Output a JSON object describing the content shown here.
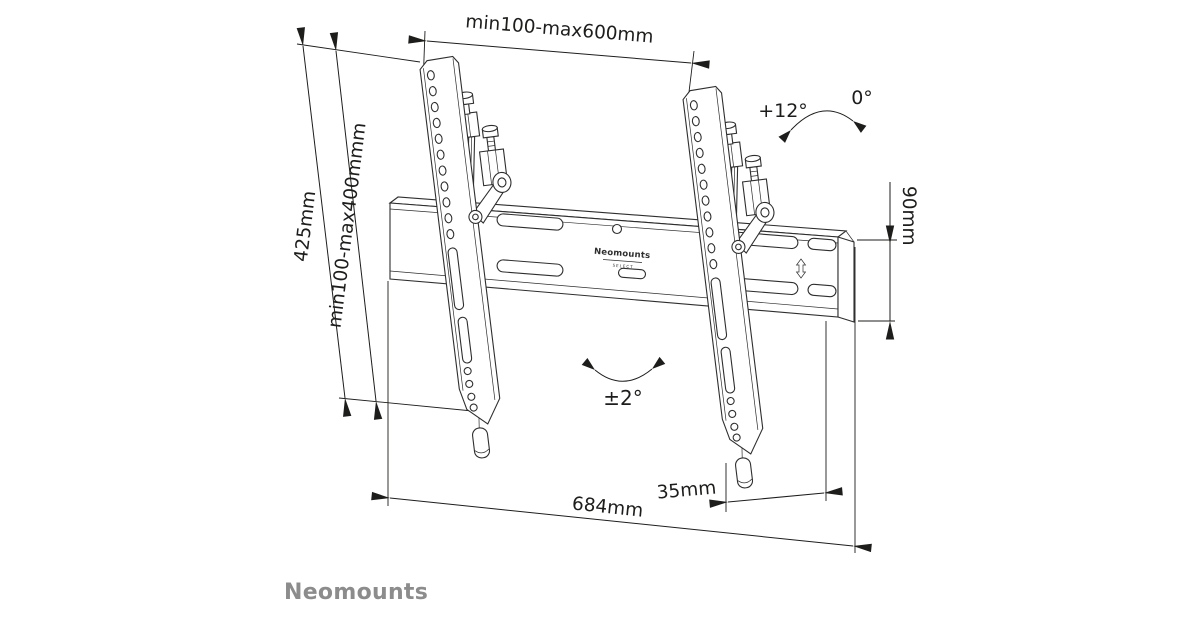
{
  "colors": {
    "background": "#ffffff",
    "line": "#1d1d1b",
    "part_line": "#2e2e2e",
    "brand_gray": "#8c8c8c"
  },
  "dimensions": {
    "top_width": "min100-max600mm",
    "overall_height": "425mm",
    "vesa_height": "min100-max400mmm",
    "tilt_max": "+12°",
    "tilt_min": "0°",
    "rail_height": "90mm",
    "swivel_range": "±2°",
    "rail_width": "684mm",
    "wall_depth": "35mm"
  },
  "rail": {
    "brand": "Neomounts",
    "series": "SELECT"
  },
  "footer": {
    "brand": "Neomounts"
  }
}
